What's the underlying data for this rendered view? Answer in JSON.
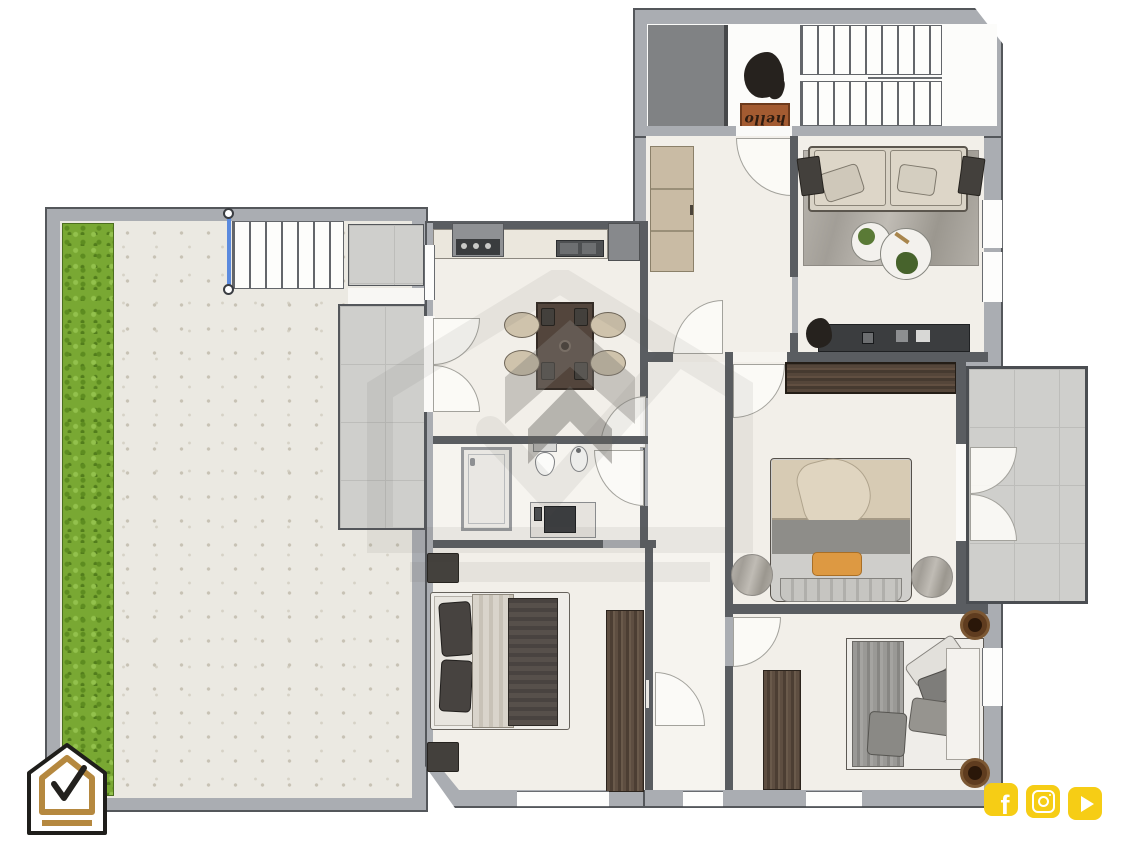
{
  "meta": {
    "type": "floor-plan",
    "view": "top-down-2d",
    "style": "rendered color plan"
  },
  "entry": {
    "doormat_text": "hello"
  },
  "branding": {
    "logo": "house-check-logo",
    "logo_colors": {
      "outline": "#1f1e1b",
      "house_stroke": "#b5883f",
      "fill": "#ffffff",
      "check": "#23211e"
    }
  },
  "social": {
    "color": "#f6cd15",
    "facebook_glyph": "f",
    "icons": [
      {
        "name": "facebook-icon"
      },
      {
        "name": "instagram-icon"
      },
      {
        "name": "youtube-icon"
      }
    ]
  },
  "palette": {
    "outer_wall": "#aaadb2",
    "inner_wall": "#5a5d61",
    "floor": "#f2efe9",
    "grass": "#79a833",
    "paving": "#ebe9e2",
    "tiles": "#cfcfcc",
    "dark_wood": "#4c3e33",
    "tan_closet": "#c9bba4",
    "stair_rail": "#5b8ade",
    "orange_pillow": "#dd9942",
    "doormat": "#a35b31",
    "elevator": "#808284"
  },
  "rooms": [
    {
      "name": "entry-stairwell",
      "features": [
        "elevator",
        "double-flight-staircase",
        "hello-doormat",
        "plant"
      ]
    },
    {
      "name": "hallway",
      "features": [
        "built-in-closet"
      ]
    },
    {
      "name": "living-room",
      "features": [
        "sofa",
        "area-rug",
        "two-round-coffee-tables",
        "tv-console",
        "plants"
      ]
    },
    {
      "name": "kitchen-dining",
      "features": [
        "counter-with-hob-and-hood",
        "sink",
        "fridge",
        "dining-table",
        "four-chairs"
      ]
    },
    {
      "name": "bathroom",
      "features": [
        "shower",
        "toilet",
        "bidet",
        "vanity"
      ]
    },
    {
      "name": "master-bedroom",
      "features": [
        "double-bed",
        "wardrobe",
        "round-rugs",
        "balcony-access"
      ]
    },
    {
      "name": "bedroom-2",
      "features": [
        "double-bed",
        "wardrobe",
        "nightstands"
      ]
    },
    {
      "name": "bedroom-3",
      "features": [
        "single-bed",
        "wardrobe",
        "round-side-tables"
      ]
    },
    {
      "name": "balcony",
      "features": [
        "tiled-floor",
        "french-doors"
      ]
    },
    {
      "name": "garden-terrace",
      "features": [
        "lawn-strip",
        "paved-patio",
        "exterior-staircase",
        "tiled-path"
      ]
    }
  ],
  "watermark": {
    "type": "house-check-logo-watermark"
  }
}
